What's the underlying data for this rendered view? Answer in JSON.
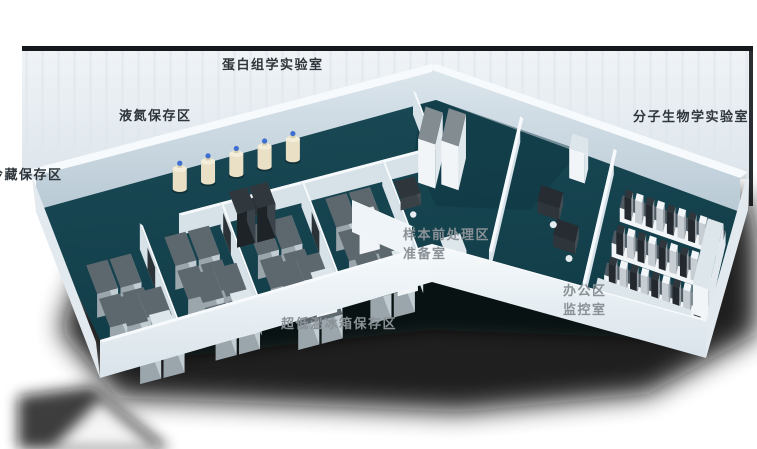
{
  "view": {
    "type": "3d-isometric-lab-floorplan",
    "width_px": 757,
    "height_px": 449
  },
  "labels": {
    "proteomics": "蛋白组学实验室",
    "liquid_nitrogen": "液氮保存区",
    "cold_storage": "冷藏保存区",
    "molecular_biology": "分子生物学实验室",
    "sample_prep": "样本前处理区",
    "prep_room": "准备室",
    "office": "办公区",
    "monitor_room": "监控室",
    "ult_freezer": "超低温冰箱保存区"
  },
  "colors": {
    "background": "#ffffff",
    "backdrop": "#eaf0f4",
    "backdrop_edge": "#15191d",
    "shadow": "#0a0d10",
    "floor": "#16434e",
    "floor_dark": "#0d3641",
    "wall_top": "#f7fafc",
    "wall_face": "#c9d7e0",
    "wall_end": "#e2eaf0",
    "front_wall": "#eef4f8",
    "partition": "#d6e1e8",
    "freezer_top": "#5d676e",
    "freezer_front": "#9aa5ac",
    "freezer_side": "#c2cdd3",
    "cabinet_top": "#dde6eb",
    "cabinet_front": "#f1f5f8",
    "cabinet_side": "#e0e8ed",
    "dark_unit": "#2b3238",
    "desk": "#2e353b",
    "bench_top": "#4f5a62",
    "tank_body": "#e9e0c6",
    "tank_top": "#f3edda",
    "tank_cap": "#3e6fd0",
    "label_dark": "#2f363b",
    "label_gray": "#8a9196"
  }
}
